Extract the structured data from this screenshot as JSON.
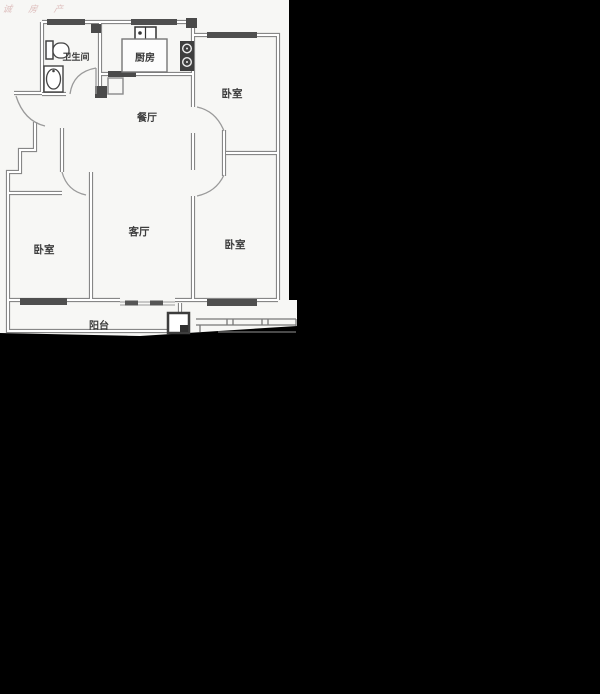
{
  "watermark": "诚 房 产",
  "floorplan": {
    "bathroom": "卫生间",
    "kitchen": "厨房",
    "dining": "餐厅",
    "bedroom_top_right": "卧室",
    "bedroom_bottom_right": "卧室",
    "bedroom_left": "卧室",
    "living": "客厅",
    "balcony": "阳台"
  },
  "colors": {
    "background": "#000000",
    "paper": "#f7f7f5",
    "wall": "#878787",
    "wall_dark": "#4f4f4f",
    "label_text": "#3d3d3d",
    "watermark": "rgba(190,120,120,0.45)"
  }
}
